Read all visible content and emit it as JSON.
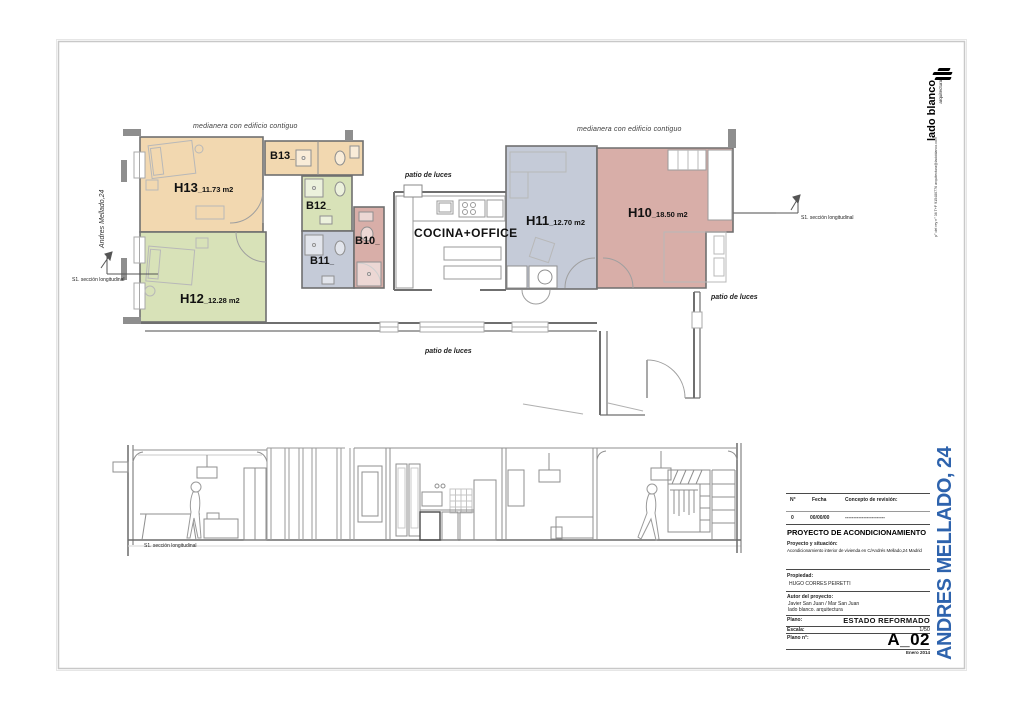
{
  "sheet": {
    "logo": {
      "name": "lado blanco",
      "tagline": "arquitectura",
      "contact": "p° del rey n° 36   T+F 915480776   arquitectura@ladoblanco.com"
    },
    "side_title": "ANDRES MELLADO, 24",
    "accent_blue": "#2e63ad"
  },
  "plan": {
    "party_wall": "medianera  con edificio contiguo",
    "street": "Andres Mellado,24",
    "section_marker": "S1. sección longitudinal",
    "patio": "patio de luces",
    "kitchen": "COCINA+OFFICE",
    "rooms": {
      "h13": {
        "name": "H13",
        "area": "_11.73 m2",
        "color": "#f2d8b0"
      },
      "h12": {
        "name": "H12",
        "area": "_12.28 m2",
        "color": "#d8e2b8"
      },
      "h11": {
        "name": "H11",
        "area": "_12.70 m2",
        "color": "#c5cbd8"
      },
      "h10": {
        "name": "H10",
        "area": "_18.50 m2",
        "color": "#d8aea8"
      },
      "b13": {
        "name": "B13",
        "area": "_",
        "color": "#f2d8b0"
      },
      "b12": {
        "name": "B12",
        "area": "_",
        "color": "#d8e2b8"
      },
      "b11": {
        "name": "B11",
        "area": "_",
        "color": "#c5cbd8"
      },
      "b10": {
        "name": "B10",
        "area": "_",
        "color": "#d8aea8"
      }
    }
  },
  "section": {
    "label": "S1. sección longitudinal"
  },
  "titleblock": {
    "rev": {
      "no_h": "N°",
      "fecha_h": "Fecha",
      "concepto_h": "Concepto de revisión:",
      "no": "0",
      "fecha": "00/00/00",
      "concepto": "------------------------"
    },
    "project_title": "PROYECTO DE ACONDICIONAMIENTO",
    "situacion_label": "Proyecto y situación:",
    "situacion": "Acondicionamiento interior de vivienda en C/Andrés Mellado,24  Madrid",
    "propiedad_label": "Propiedad:",
    "propiedad": "HUGO CORRES PEIRETTI",
    "autor_label": "Autor del proyecto:",
    "autor_1": "Javier San Juan / Mar San Juan",
    "autor_2": "lado blanco. arquitectura",
    "plano_label": "Plano:",
    "plano": "ESTADO REFORMADO",
    "escala_label": "Escala:",
    "escala": "1/50",
    "numero_label": "Plano n°:",
    "numero": "A_02",
    "fecha_plano": "Enero 2014"
  }
}
